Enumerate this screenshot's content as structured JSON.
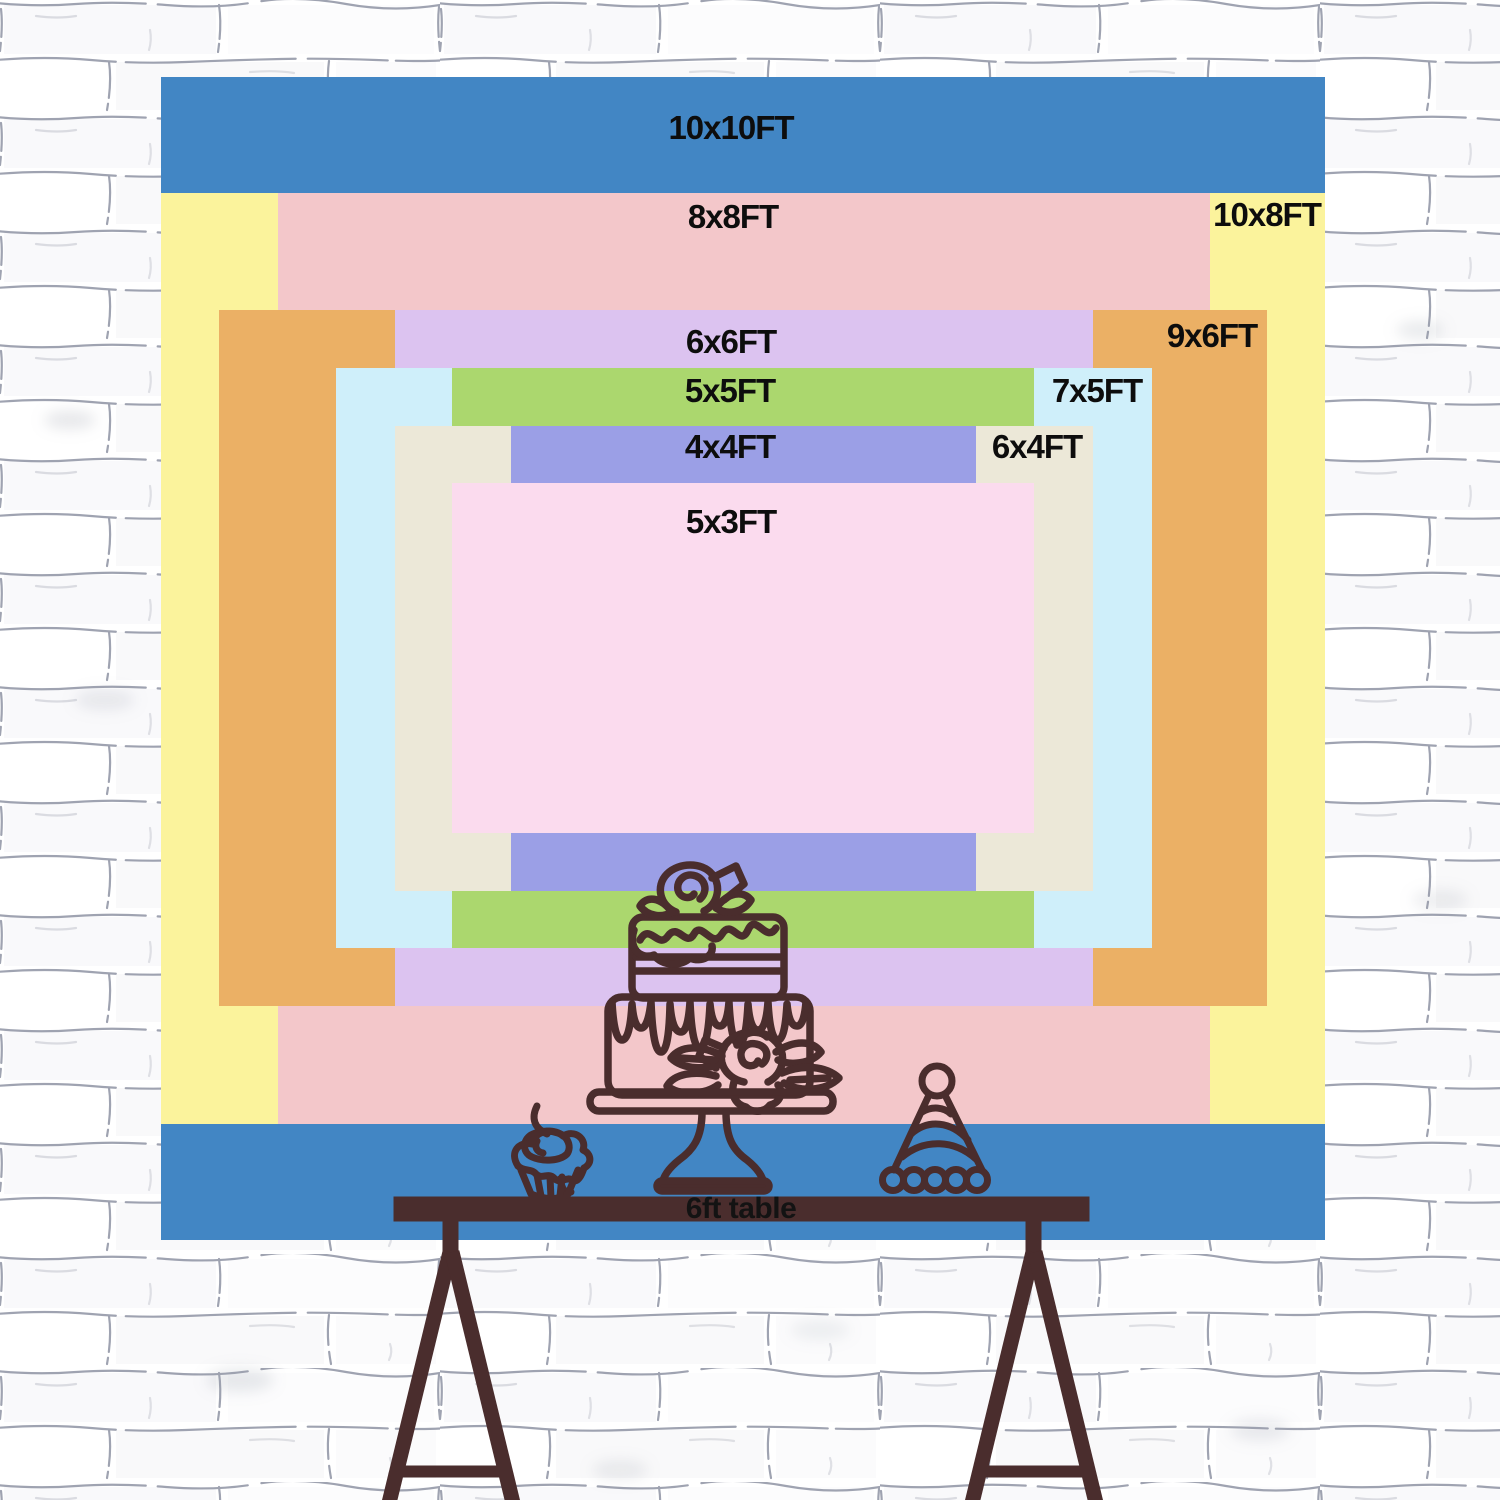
{
  "diagram": {
    "description": "Backdrop size comparison chart with nested colored rectangles on a white brick wall",
    "sizes": [
      {
        "label": "10x10FT",
        "width_ft": 10,
        "height_ft": 10,
        "color": "#4286C4"
      },
      {
        "label": "10x8FT",
        "width_ft": 10,
        "height_ft": 8,
        "color": "#FBF39C"
      },
      {
        "label": "8x8FT",
        "width_ft": 8,
        "height_ft": 8,
        "color": "#F3C7CA"
      },
      {
        "label": "9x6FT",
        "width_ft": 9,
        "height_ft": 6,
        "color": "#EBB065"
      },
      {
        "label": "6x6FT",
        "width_ft": 6,
        "height_ft": 6,
        "color": "#DCC3F0"
      },
      {
        "label": "7x5FT",
        "width_ft": 7,
        "height_ft": 5,
        "color": "#CFEFFA"
      },
      {
        "label": "5x5FT",
        "width_ft": 5,
        "height_ft": 5,
        "color": "#ABD76E"
      },
      {
        "label": "6x4FT",
        "width_ft": 6,
        "height_ft": 4,
        "color": "#ECE8D8"
      },
      {
        "label": "4x4FT",
        "width_ft": 4,
        "height_ft": 4,
        "color": "#9B9FE6"
      },
      {
        "label": "5x3FT",
        "width_ft": 5,
        "height_ft": 3,
        "color": "#FBDBEE"
      }
    ],
    "table": {
      "label": "6ft table",
      "color": "#4A2D2D"
    },
    "artwork": {
      "stroke_color": "#4A2D2D",
      "items": [
        "tiered-cake-on-stand",
        "cupcake-with-cherry",
        "party-hat"
      ]
    },
    "wall": {
      "base_color": "#FDFDFE",
      "mortar_color": "#8E93A3"
    }
  }
}
